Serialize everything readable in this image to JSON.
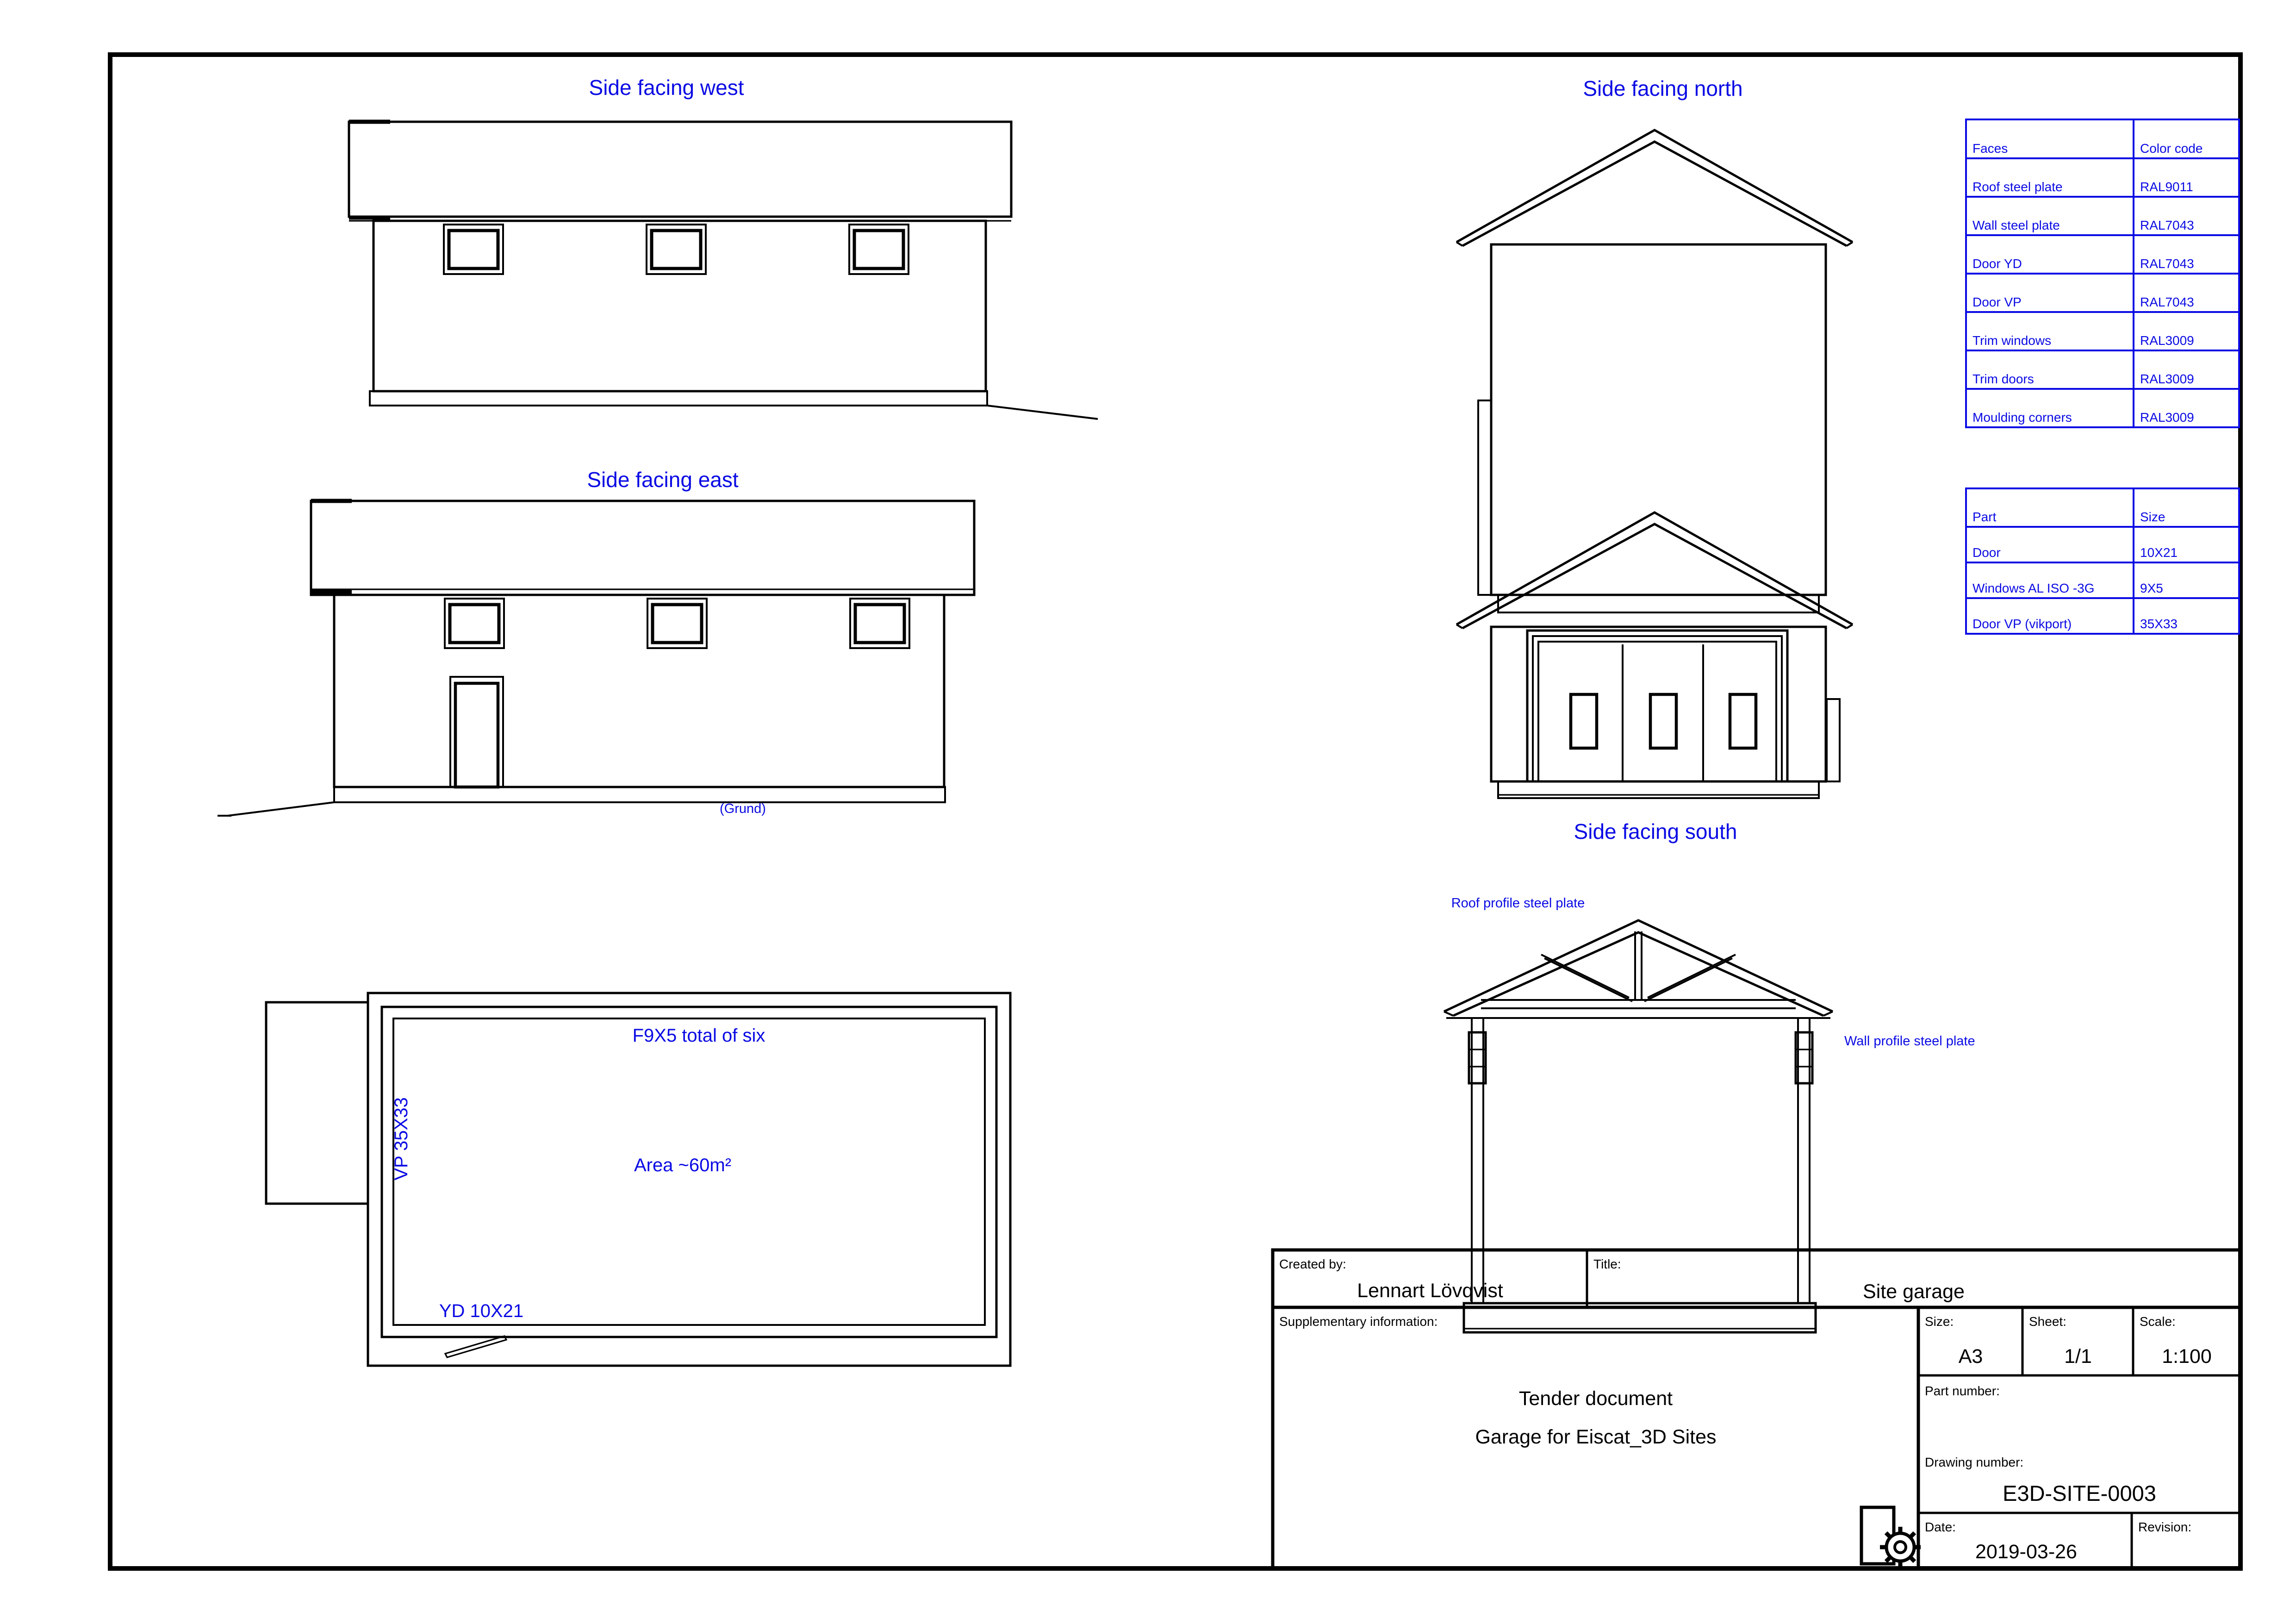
{
  "sheet": {
    "views": {
      "west": {
        "title": "Side facing west"
      },
      "east": {
        "title": "Side facing east",
        "ground": "(Grund)"
      },
      "north": {
        "title": "Side facing north"
      },
      "south": {
        "title": "Side facing south"
      },
      "section": {
        "roof_label": "Roof profile steel plate",
        "wall_label": "Wall profile steel plate"
      },
      "plan": {
        "windows": "F9X5 total of six",
        "area": "Area ~60m²",
        "vp": "VP 35X33",
        "yd": "YD 10X21"
      }
    },
    "tables": {
      "colors": {
        "headers": [
          "Faces",
          "Color code"
        ],
        "rows": [
          [
            "Roof steel plate",
            "RAL9011"
          ],
          [
            "Wall steel plate",
            "RAL7043"
          ],
          [
            "Door YD",
            "RAL7043"
          ],
          [
            "Door VP",
            "RAL7043"
          ],
          [
            "Trim windows",
            "RAL3009"
          ],
          [
            "Trim doors",
            "RAL3009"
          ],
          [
            "Moulding corners",
            "RAL3009"
          ]
        ]
      },
      "parts": {
        "headers": [
          "Part",
          "Size"
        ],
        "rows": [
          [
            "Door",
            "10X21"
          ],
          [
            "Windows AL ISO -3G",
            "9X5"
          ],
          [
            "Door VP (vikport)",
            "35X33"
          ]
        ]
      }
    },
    "title_block": {
      "created_by_label": "Created by:",
      "created_by": "Lennart Lövqvist",
      "title_label": "Title:",
      "title": "Site garage",
      "supplementary_label": "Supplementary information:",
      "supplementary_line1": "Tender document",
      "supplementary_line2": "Garage for Eiscat_3D Sites",
      "size_label": "Size:",
      "size": "A3",
      "sheet_label": "Sheet:",
      "sheet": "1/1",
      "scale_label": "Scale:",
      "scale": "1:100",
      "part_number_label": "Part number:",
      "drawing_number_label": "Drawing number:",
      "drawing_number": "E3D-SITE-0003",
      "date_label": "Date:",
      "date": "2019-03-26",
      "revision_label": "Revision:"
    },
    "colors": {
      "annotation_blue": "#0a0ae4",
      "line_black": "#000000"
    }
  }
}
